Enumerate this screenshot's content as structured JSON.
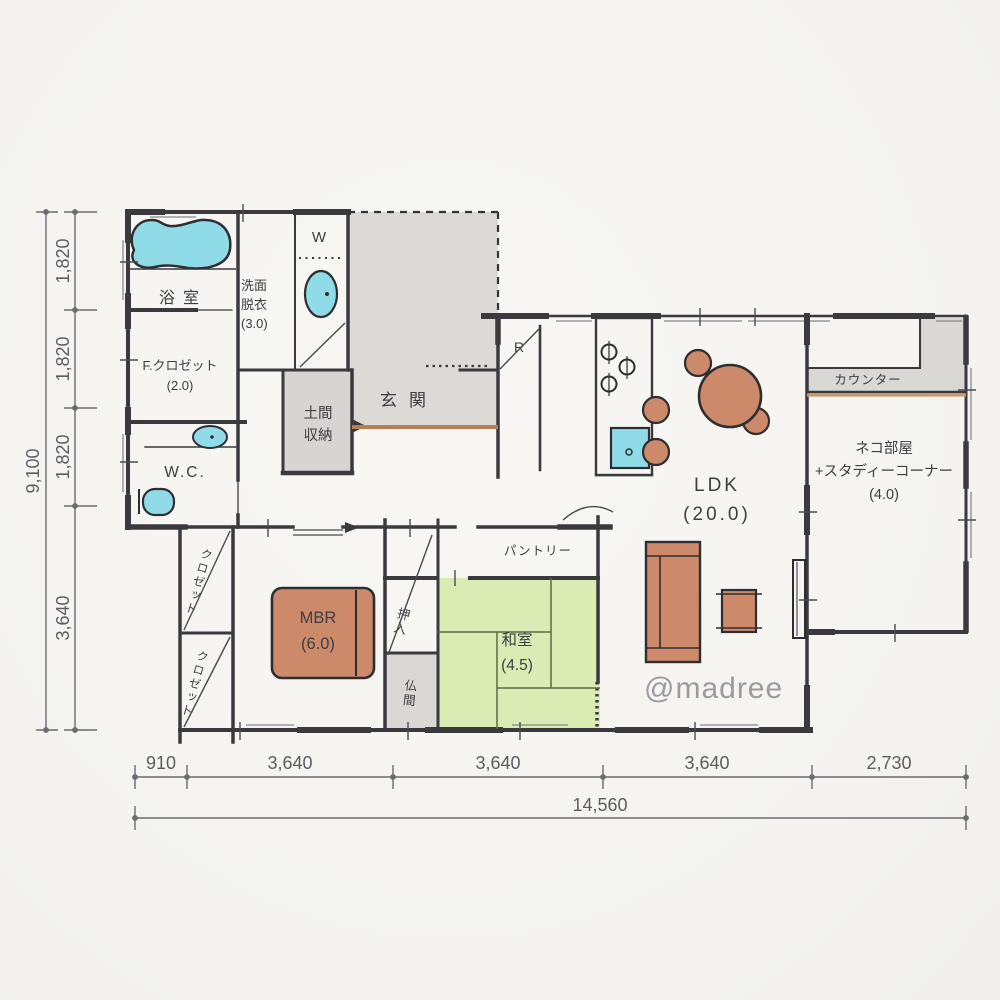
{
  "plan": {
    "bath": "浴室",
    "washroom": "洗面\n脱衣\n(3.0)",
    "washer": "W",
    "family_closet": "F.クロゼット\n(2.0)",
    "wc": "W.C.",
    "doma_storage": "土間\n収納",
    "genkan": "玄関",
    "fridge": "R",
    "pantry": "パントリー",
    "oshiire": "押入",
    "butsuma": "仏間",
    "closet_upper": "クロゼット",
    "closet_lower": "クロゼット",
    "mbr": "MBR\n(6.0)",
    "washitsu": "和室\n(4.5)",
    "ldk": "LDK\n(20.0)",
    "counter": "カウンター",
    "cat_room": "ネコ部屋\n+スタディーコーナー\n(4.0)"
  },
  "dimensions": {
    "left": {
      "segments": [
        "1,820",
        "1,820",
        "1,820",
        "3,640"
      ],
      "total": "9,100"
    },
    "bottom": {
      "segments": [
        "910",
        "3,640",
        "3,640",
        "3,640",
        "2,730"
      ],
      "total": "14,560"
    }
  },
  "watermark": "@madree",
  "colors": {
    "wall": "#3a3a3e",
    "water_fixture": "#8fdbe8",
    "furniture": "#cd8a6b",
    "tatami": "#d9ecb4",
    "floor_grey": "#dbdad6",
    "wood_edge": "#b68052"
  }
}
